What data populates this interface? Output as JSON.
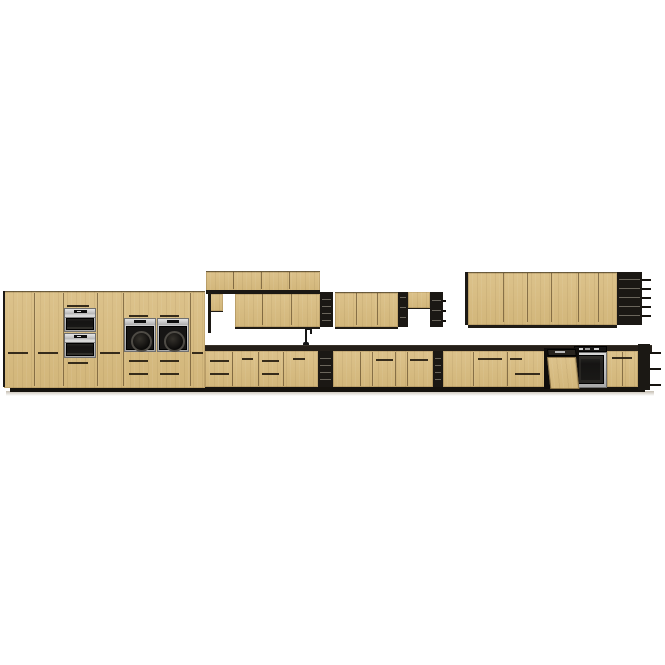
{
  "meta": {
    "description": "Product render of a long modular kitchen cabinet set, light oak fronts with black open shelving and built-in appliances, on white background",
    "canvas": {
      "width": 665,
      "height": 665,
      "background": "#ffffff"
    }
  },
  "palette": {
    "wood": "#d6ba82",
    "wood_light": "#dcc28b",
    "wood_shadow": "#c4a76e",
    "black_panel": "#1b1814",
    "shelf_line": "#6b665c",
    "countertop": "#251f19",
    "plinth": "#16130e",
    "steel": "#b5b5b5",
    "steel_dark": "#7d7d7d",
    "glass": "#181716",
    "display": "#0e0e0e",
    "display_tick": "#d8d8d8",
    "floor_shadow": "#a79d8b"
  },
  "scene": {
    "wood_panels": [
      {
        "name": "tall-cabinet-run",
        "x": 4,
        "y": 291,
        "w": 201,
        "h": 96,
        "bt": 1,
        "bb": 0
      },
      {
        "name": "wall-top-row",
        "x": 206,
        "y": 271,
        "w": 114,
        "h": 19,
        "bt": 1,
        "bb": 0
      },
      {
        "name": "wall-half-cabinet-left",
        "x": 210,
        "y": 294,
        "w": 13,
        "h": 17,
        "bt": 0,
        "bb": 1
      },
      {
        "name": "wall-second-row",
        "x": 235,
        "y": 293,
        "w": 85,
        "h": 33,
        "bt": 1,
        "bb": 2
      },
      {
        "name": "wall-mid-cabinet",
        "x": 335,
        "y": 292,
        "w": 63,
        "h": 34,
        "bt": 1,
        "bb": 2
      },
      {
        "name": "wall-half-cabinet-right",
        "x": 408,
        "y": 292,
        "w": 22,
        "h": 16,
        "bt": 0,
        "bb": 1
      },
      {
        "name": "wall-cabinet-large-right",
        "x": 468,
        "y": 272,
        "w": 149,
        "h": 52,
        "bt": 1,
        "bb": 3
      },
      {
        "name": "base-cabinet-left",
        "x": 205,
        "y": 351,
        "w": 113,
        "h": 36,
        "bt": 0,
        "bb": 0
      },
      {
        "name": "base-cabinet-mid",
        "x": 333,
        "y": 351,
        "w": 100,
        "h": 36,
        "bt": 0,
        "bb": 0
      },
      {
        "name": "base-cabinet-right",
        "x": 443,
        "y": 351,
        "w": 102,
        "h": 36,
        "bt": 0,
        "bb": 0
      },
      {
        "name": "base-cabinet-far-right",
        "x": 607,
        "y": 351,
        "w": 31,
        "h": 36,
        "bt": 0,
        "bb": 0
      }
    ],
    "black_panels": [
      {
        "name": "tall-left-side-panel",
        "x": 3,
        "y": 291,
        "w": 2,
        "h": 96
      },
      {
        "name": "wall-side-panel",
        "x": 208,
        "y": 294,
        "w": 3,
        "h": 39
      },
      {
        "name": "wall-top-row-underside",
        "x": 206,
        "y": 290,
        "w": 114,
        "h": 4
      },
      {
        "name": "large-cabinet-side-panel",
        "x": 465,
        "y": 272,
        "w": 3,
        "h": 53
      }
    ],
    "shelf_units": [
      {
        "name": "open-shelf-upper-1",
        "x": 320,
        "y": 292,
        "w": 13,
        "h": 35,
        "shelves": [
          7,
          14,
          21,
          28
        ],
        "dashes": [],
        "dash_len": 0
      },
      {
        "name": "open-shelf-upper-2",
        "x": 398,
        "y": 292,
        "w": 10,
        "h": 35,
        "shelves": [
          5,
          15,
          25
        ],
        "dashes": [],
        "dash_len": 0
      },
      {
        "name": "open-shelf-upper-3",
        "x": 430,
        "y": 292,
        "w": 13,
        "h": 35,
        "shelves": [
          8,
          18,
          28
        ],
        "dashes": [
          8,
          18,
          28
        ],
        "dash_len": 3
      },
      {
        "name": "open-shelf-base-1",
        "x": 318,
        "y": 351,
        "w": 15,
        "h": 36,
        "shelves": [
          7,
          14,
          21,
          28
        ],
        "dashes": [],
        "dash_len": 0
      },
      {
        "name": "open-shelf-base-2",
        "x": 433,
        "y": 351,
        "w": 10,
        "h": 36,
        "shelves": [
          7,
          14,
          21,
          28
        ],
        "dashes": [],
        "dash_len": 0
      },
      {
        "name": "open-shelf-wall-end",
        "x": 617,
        "y": 272,
        "w": 25,
        "h": 53,
        "shelves": [
          7,
          16,
          25,
          34,
          43
        ],
        "dashes": [
          7,
          16,
          25,
          34,
          43
        ],
        "dash_len": 9
      },
      {
        "name": "open-shelf-base-end",
        "x": 638,
        "y": 344,
        "w": 12,
        "h": 46,
        "shelves": [],
        "dashes": [
          8,
          24,
          40
        ],
        "dash_len": 11
      }
    ],
    "seams": [
      {
        "x": 34,
        "y": 293,
        "h": 93
      },
      {
        "x": 63,
        "y": 293,
        "h": 93
      },
      {
        "x": 97,
        "y": 293,
        "h": 93
      },
      {
        "x": 123,
        "y": 293,
        "h": 93
      },
      {
        "x": 190,
        "y": 293,
        "h": 93
      },
      {
        "x": 233,
        "y": 272,
        "h": 17
      },
      {
        "x": 261,
        "y": 272,
        "h": 17
      },
      {
        "x": 289,
        "y": 272,
        "h": 17
      },
      {
        "x": 262,
        "y": 294,
        "h": 31
      },
      {
        "x": 291,
        "y": 294,
        "h": 31
      },
      {
        "x": 356,
        "y": 293,
        "h": 32
      },
      {
        "x": 377,
        "y": 293,
        "h": 32
      },
      {
        "x": 503,
        "y": 273,
        "h": 49
      },
      {
        "x": 527,
        "y": 273,
        "h": 49
      },
      {
        "x": 551,
        "y": 273,
        "h": 49
      },
      {
        "x": 578,
        "y": 273,
        "h": 49
      },
      {
        "x": 598,
        "y": 273,
        "h": 49
      },
      {
        "x": 232,
        "y": 352,
        "h": 34
      },
      {
        "x": 258,
        "y": 352,
        "h": 34
      },
      {
        "x": 283,
        "y": 352,
        "h": 34
      },
      {
        "x": 360,
        "y": 352,
        "h": 34
      },
      {
        "x": 372,
        "y": 352,
        "h": 34
      },
      {
        "x": 395,
        "y": 352,
        "h": 34
      },
      {
        "x": 407,
        "y": 352,
        "h": 34
      },
      {
        "x": 473,
        "y": 352,
        "h": 34
      },
      {
        "x": 507,
        "y": 352,
        "h": 34
      },
      {
        "x": 622,
        "y": 352,
        "h": 34
      }
    ],
    "handles": [
      {
        "x": 8,
        "y": 352,
        "w": 20
      },
      {
        "x": 38,
        "y": 352,
        "w": 20
      },
      {
        "x": 100,
        "y": 352,
        "w": 20
      },
      {
        "x": 192,
        "y": 352,
        "w": 11
      },
      {
        "x": 67,
        "y": 305,
        "w": 22
      },
      {
        "x": 68,
        "y": 362,
        "w": 20
      },
      {
        "x": 129,
        "y": 315,
        "w": 19
      },
      {
        "x": 160,
        "y": 315,
        "w": 19
      },
      {
        "x": 129,
        "y": 360,
        "w": 19
      },
      {
        "x": 160,
        "y": 360,
        "w": 19
      },
      {
        "x": 129,
        "y": 373,
        "w": 19
      },
      {
        "x": 160,
        "y": 373,
        "w": 19
      },
      {
        "x": 210,
        "y": 360,
        "w": 19
      },
      {
        "x": 210,
        "y": 373,
        "w": 19
      },
      {
        "x": 242,
        "y": 358,
        "w": 11
      },
      {
        "x": 262,
        "y": 360,
        "w": 17
      },
      {
        "x": 262,
        "y": 373,
        "w": 17
      },
      {
        "x": 293,
        "y": 358,
        "w": 12
      },
      {
        "x": 376,
        "y": 359,
        "w": 17
      },
      {
        "x": 410,
        "y": 359,
        "w": 18
      },
      {
        "x": 478,
        "y": 358,
        "w": 24
      },
      {
        "x": 510,
        "y": 358,
        "w": 12
      },
      {
        "x": 515,
        "y": 373,
        "w": 25
      },
      {
        "x": 612,
        "y": 357,
        "w": 20
      }
    ],
    "countertop": {
      "x": 203,
      "y": 345,
      "w": 449,
      "h": 6
    },
    "plinth": {
      "x": 10,
      "y": 386,
      "w": 635,
      "h": 6
    },
    "floor_shadow": {
      "x": 6,
      "y": 391,
      "w": 648,
      "h": 5
    },
    "appliances": {
      "wall_ovens": [
        {
          "name": "built-in-oven-upper",
          "x": 64,
          "y": 308,
          "w": 32,
          "h": 24
        },
        {
          "name": "built-in-oven-lower",
          "x": 64,
          "y": 333,
          "w": 32,
          "h": 25
        }
      ],
      "dial_ovens": [
        {
          "name": "compact-oven-left",
          "x": 124,
          "y": 318,
          "w": 32,
          "h": 34
        },
        {
          "name": "compact-oven-right",
          "x": 157,
          "y": 318,
          "w": 32,
          "h": 34
        }
      ],
      "base_oven": {
        "name": "built-in-oven-base",
        "x": 574,
        "y": 346,
        "w": 33,
        "h": 42
      },
      "dishwasher": {
        "name": "dishwasher-open",
        "back": {
          "x": 544,
          "y": 348,
          "w": 35,
          "h": 41
        },
        "strip": {
          "x": 547,
          "y": 349,
          "w": 29,
          "h": 7
        },
        "door": {
          "x": 547,
          "y": 357,
          "w": 29,
          "h": 32
        },
        "skew_deg": 6
      },
      "faucet": {
        "name": "sink-faucet",
        "stem": {
          "x": 305,
          "y": 330,
          "w": 2,
          "h": 15
        },
        "spout": {
          "x": 305,
          "y": 328,
          "w": 7,
          "h": 2
        },
        "tip": {
          "x": 310,
          "y": 330,
          "w": 2,
          "h": 4
        },
        "base": {
          "x": 303,
          "y": 342,
          "w": 6,
          "h": 3
        }
      }
    }
  }
}
